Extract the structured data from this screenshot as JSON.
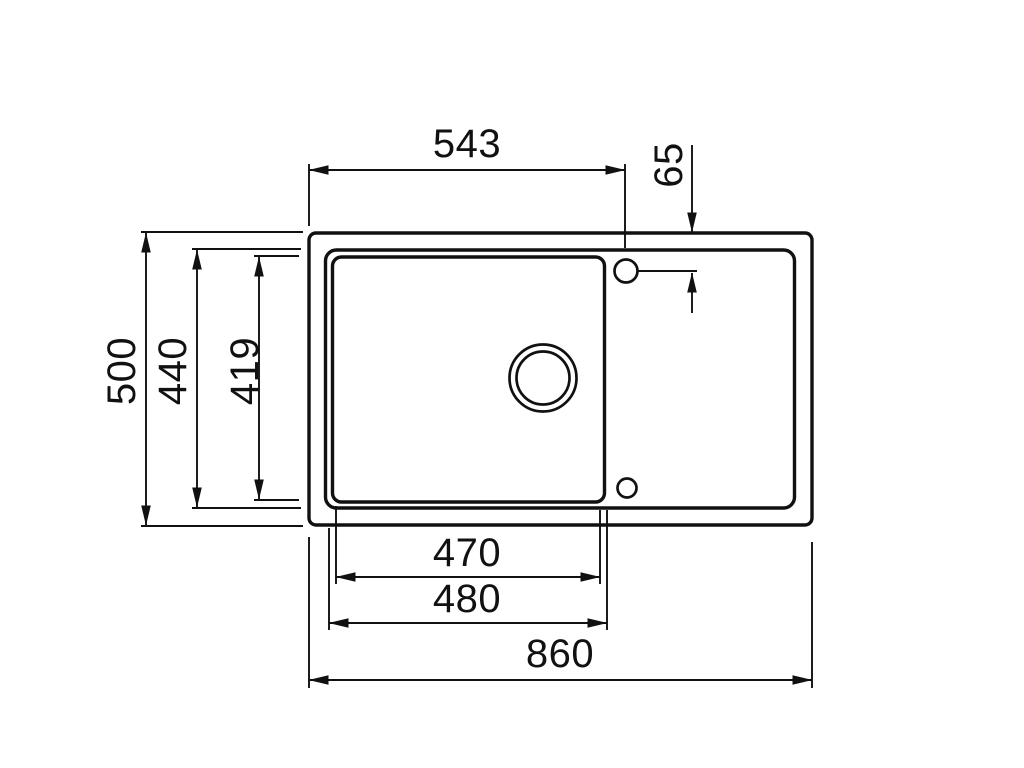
{
  "drawing": {
    "title": "sink-top-view-dimension-drawing",
    "colors": {
      "line": "#111111",
      "background": "#ffffff"
    },
    "dimensions": {
      "bowl_center_from_left": "543",
      "tap_hole_offset": "65",
      "overall_depth": "500",
      "inner_rim_depth": "440",
      "bowl_inner_depth": "419",
      "bowl_inner_width": "470",
      "bowl_outer_width": "480",
      "overall_width": "860"
    }
  }
}
